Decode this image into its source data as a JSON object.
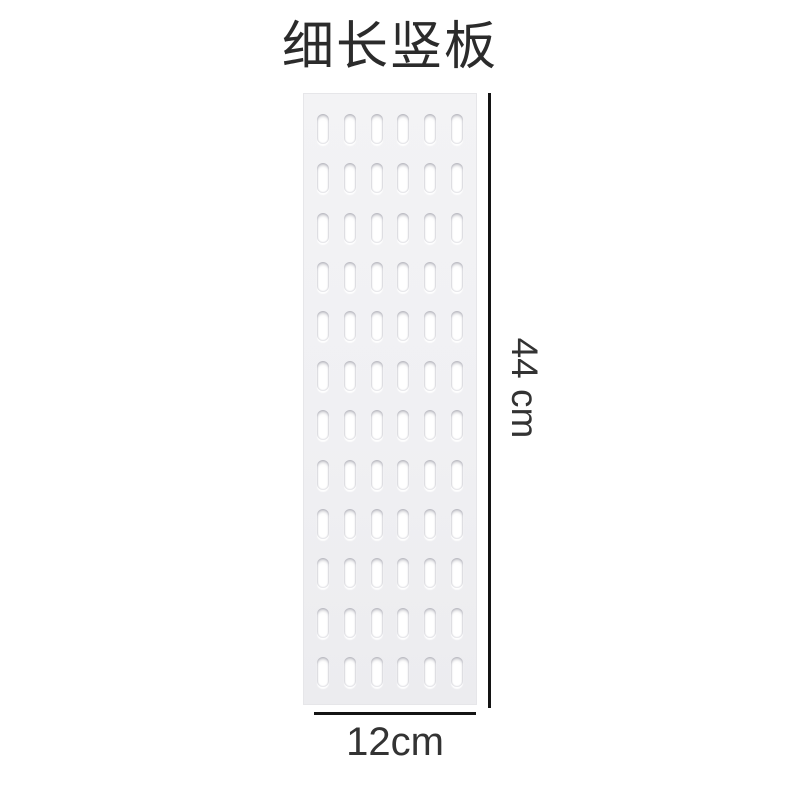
{
  "figure": {
    "title": "细长竖板",
    "product": {
      "type": "pegboard-panel",
      "slot_rows": 12,
      "slot_columns": 6,
      "board_color": "#f1f1f3",
      "slot_color": "#ffffff"
    },
    "dimensions": {
      "height_label": "44 cm",
      "width_label": "12cm",
      "line_color": "#141414",
      "text_color": "#333333"
    }
  }
}
